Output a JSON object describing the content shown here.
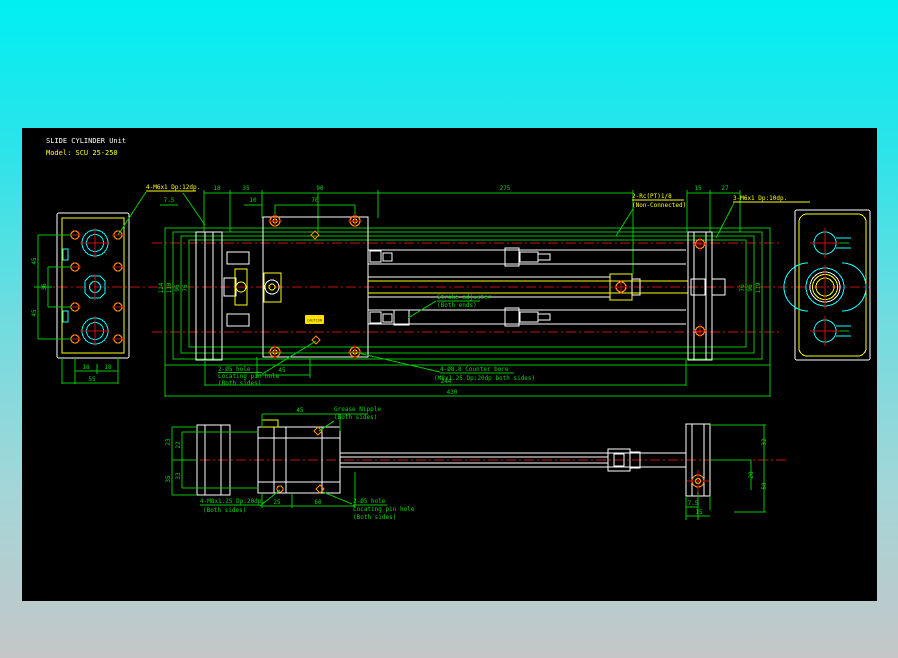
{
  "title": {
    "product": "SLIDE CYLINDER Unit",
    "model": "Model: SCU 25-250"
  },
  "colors": {
    "dimension": "#00c400",
    "centerline": "#cc1010",
    "geometry": "#ffffff",
    "highlight": "#ffff00",
    "bore": "#00ffff",
    "hole": "#ff8800",
    "canvas": "#000000",
    "background_top": "#00f0f2",
    "background_bottom": "#c4c6c7"
  },
  "left_view": {
    "dim_top_45": "45",
    "dim_mid_36": "36",
    "dim_bot_45": "45",
    "dim_18a": "18",
    "dim_18b": "18",
    "dim_55": "55"
  },
  "front_view": {
    "label_tap_left": "4-M6x1 Dp:12dp.",
    "dims_top": {
      "d18": "18",
      "d35": "35",
      "d90": "90",
      "d275": "275",
      "d15": "15",
      "d27": "27",
      "d7_5": "7.5",
      "d10": "10",
      "d70": "70"
    },
    "label_port_line1": "2-Rc(PT)1/8",
    "label_port_line2": "(Non-Connected)",
    "label_tap_right": "3-M6x1 Dp:10dp.",
    "dims_left": {
      "d124": "124",
      "d110": "110",
      "d96": "96",
      "d76": "76"
    },
    "dims_right": {
      "d76": "76",
      "d96": "96",
      "d119": "119"
    },
    "label_pin_line1": "2-Ø5 hole",
    "label_pin_line2": "Locating pin hole",
    "label_pin_line3": "(Both sides)",
    "dim_45": "45",
    "label_cbore_line1": "4-Ø8.8 Counter bore",
    "label_cbore_line2": "(M8x1.25 Dp:20dp both sides)",
    "label_stroke_line1": "Stroke adjuster",
    "label_stroke_line2": "(Both ends)",
    "dim_244": "244",
    "dim_430": "430",
    "plate_text": "CAUTION"
  },
  "top_view": {
    "dim_45": "45",
    "label_grease_line1": "Grease Nipple",
    "label_grease_line2": "(Both sides)",
    "dims_left": {
      "d23": "23",
      "d22": "22",
      "d35": "35",
      "d33": "33"
    },
    "label_tap_line1": "4-M8x1.25 Dp:20dp.",
    "label_tap_line2": "(Both sides)",
    "dim_25": "25",
    "dim_60": "60",
    "label_pin_line1": "2-Ø5 hole",
    "label_pin_line2": "Locating pin hole",
    "label_pin_line3": "(Both sides)",
    "dims_right": {
      "d32": "32",
      "d50": "50",
      "d20": "20",
      "d7_5": "7.5",
      "d15": "15"
    }
  }
}
